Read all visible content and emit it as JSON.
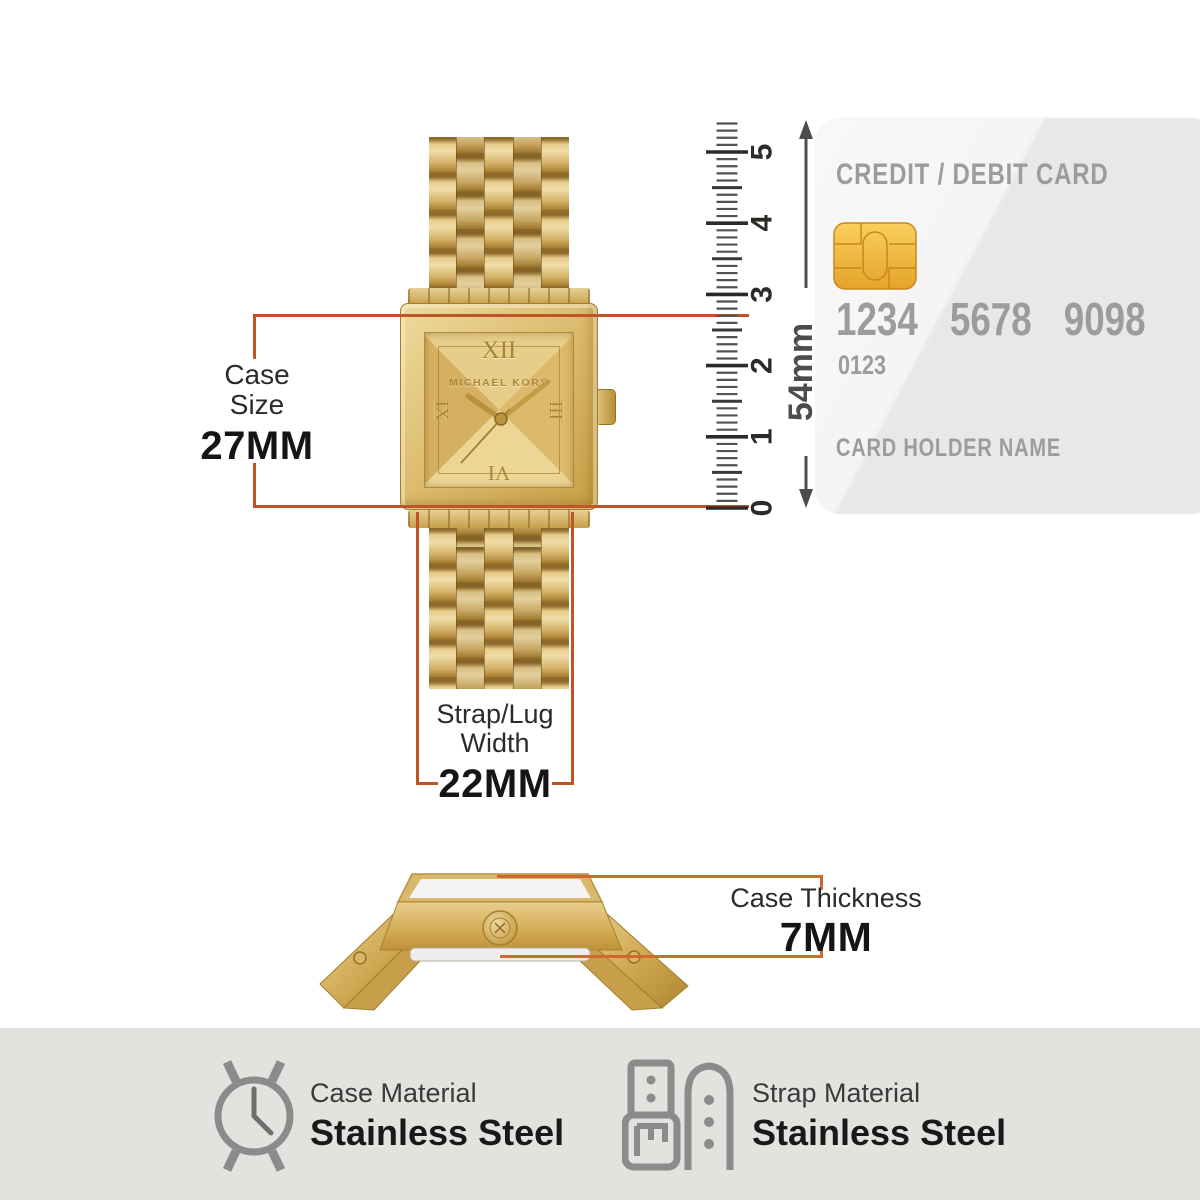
{
  "measurements": {
    "case_size": {
      "line1": "Case",
      "line2": "Size",
      "value": "27MM"
    },
    "strap_width": {
      "line1": "Strap/Lug",
      "line2": "Width",
      "value": "22MM"
    },
    "case_thickness": {
      "label": "Case Thickness",
      "value": "7MM"
    },
    "card_height_label": "54mm"
  },
  "ruler": {
    "labels": [
      "0",
      "1",
      "2",
      "3",
      "4",
      "5"
    ],
    "minor_per_unit": 10,
    "extra_minor": 4
  },
  "card": {
    "title": "CREDIT / DEBIT CARD",
    "numbers": [
      "1234",
      "5678",
      "9098"
    ],
    "sub_number": "0123",
    "holder": "CARD HOLDER NAME"
  },
  "watch": {
    "brand": "MICHAEL KORS",
    "markers": {
      "top": "XII",
      "left": "IX",
      "right": "III",
      "bottom": "VI"
    }
  },
  "specs": {
    "case": {
      "label": "Case Material",
      "value": "Stainless Steel"
    },
    "strap": {
      "label": "Strap Material",
      "value": "Stainless Steel"
    }
  },
  "colors": {
    "accent": "#bf5527",
    "accent2": "#cd6a30",
    "strip_bg": "#e4e2df",
    "arrow": "#4c4c4c",
    "ink": "#2b2b2b",
    "value_ink": "#151515",
    "card_bg": "#e9e8e7",
    "card_text": "#9c9c9c",
    "chip_gold": "#eeb534",
    "gold_mid": "#d5b469"
  }
}
